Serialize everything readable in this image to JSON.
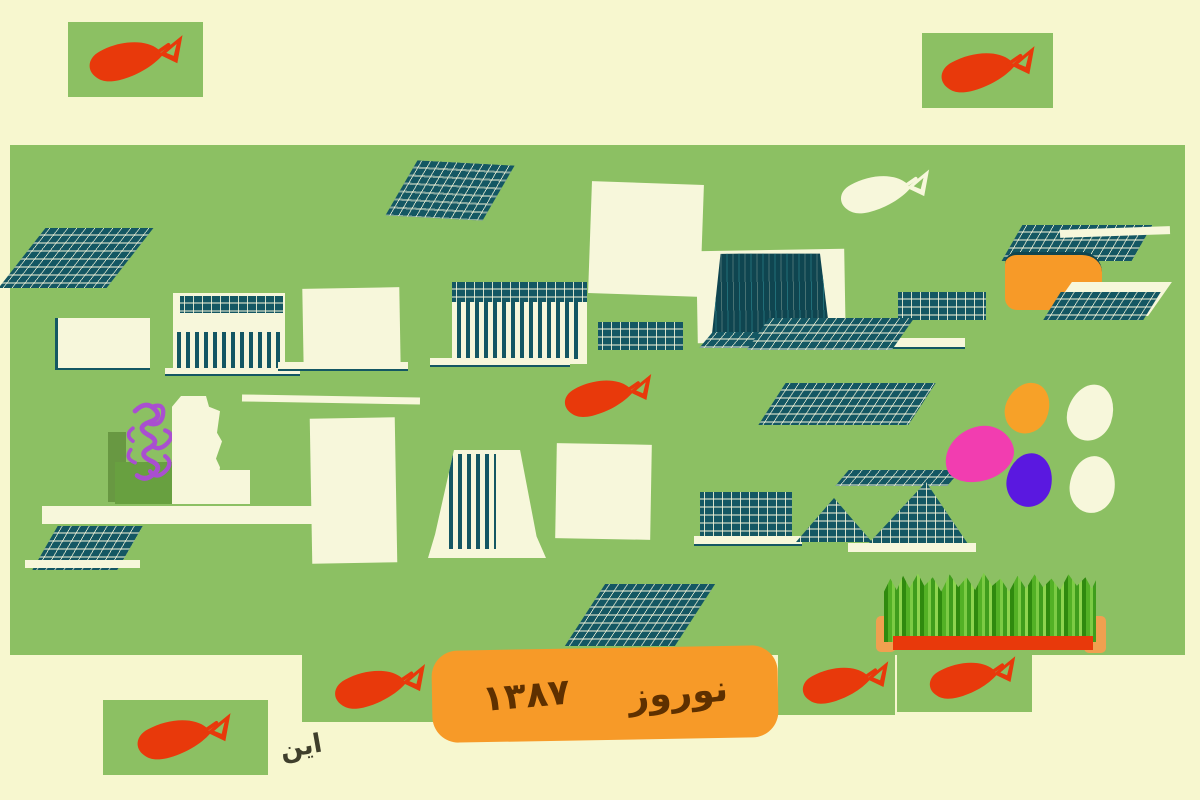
{
  "artwork": {
    "description": "Nowruz 1387 child-style painting: goldfish, sabzeh grass, painted eggs, hyacinth and abstract teal book doodles on a green canvas",
    "banner": {
      "title": "نوروز",
      "year": "۱۳۸۷"
    },
    "signature": "این",
    "icons": {
      "goldfish": "fish-blob-with-triangle-tail",
      "white-fish": "fish-blob-with-triangle-tail",
      "hyacinth": "purple-scribble-loops",
      "sabzeh": "jagged-green-grass-block",
      "eggs": [
        "orange",
        "pink",
        "purple",
        "cream",
        "cream"
      ]
    },
    "colors": {
      "background": "#F7F7CF",
      "canvas_green": "#8CC063",
      "fish_red": "#E8390B",
      "banner_orange": "#F79A28",
      "teal": "#145763",
      "teal_dark": "#0F4550",
      "cream": "#F7F7DB",
      "grass_dark": "#2F8A0E",
      "grass_mid": "#53B125",
      "grass_light": "#7CCB44",
      "tray_red": "#E8390B",
      "post_orange": "#F0A050",
      "egg_pink": "#F23DB0",
      "egg_purple": "#5A18E0",
      "egg_orange": "#F7A128",
      "hyacinth_purple": "#A94FD0",
      "pot_green": "#68A040",
      "pot_shadow": "#588834",
      "ink": "#3F3F2C",
      "text_brown": "#5E3000"
    }
  }
}
